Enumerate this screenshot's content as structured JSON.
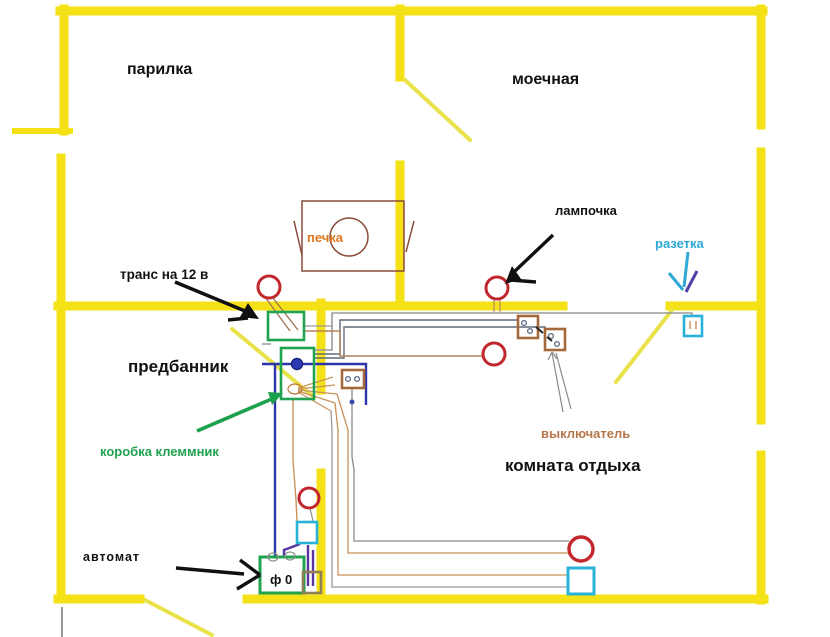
{
  "diagram": {
    "type": "sauna-electrical-wiring-plan",
    "background": "#ffffff",
    "colors": {
      "wall_yellow": "#f5e216",
      "door_yellow": "#e9e24a",
      "lamp_red": "#c1272d",
      "box_green": "#1fa34f",
      "socket_cyan": "#29b2d8",
      "switch_brown": "#a5683a",
      "wire_blue": "#2d35ad",
      "wire_purple": "#5a35a0",
      "wire_tan": "#c8925a",
      "wire_gray": "#9a9a9a",
      "arrow_black": "#111111",
      "stove_outline": "#8a4a3a",
      "label_orange": "#e0751f",
      "label_cyan": "#2aa8d8",
      "label_green": "#1fa34f",
      "label_brown": "#b5764a"
    },
    "rooms": [
      {
        "id": "parilka",
        "label": "парилка"
      },
      {
        "id": "moechnaya",
        "label": "моечная"
      },
      {
        "id": "predbannik",
        "label": "предбанник"
      },
      {
        "id": "komnata_otdyha",
        "label": "комната отдыха"
      }
    ],
    "labels": {
      "parilka": "парилка",
      "moechnaya": "моечная",
      "pechka": "печка",
      "lampochka": "лампочка",
      "rozetka": "разетка",
      "trans": "транс на 12 в",
      "predbannik": "предбанник",
      "korobka": "коробка клеммник",
      "vyklyuchatel": "выключатель",
      "komnata": "комната отдыха",
      "avtomat": "автомат",
      "breaker_text": "ф 0"
    },
    "symbols": {
      "lamp": {
        "shape": "red-circle",
        "count": 5
      },
      "socket": {
        "shape": "cyan-square",
        "count": 3
      },
      "switch": {
        "shape": "brown-box-two-dots",
        "count": 3
      },
      "stove": {
        "shape": "rect-with-circle",
        "count": 1
      },
      "transformer_box": {
        "shape": "green-rect",
        "count": 1
      },
      "junction_box": {
        "shape": "green-rect-with-blue-dot",
        "count": 1
      },
      "breaker_box": {
        "shape": "green-rect",
        "count": 1,
        "text": "ф 0"
      }
    }
  }
}
